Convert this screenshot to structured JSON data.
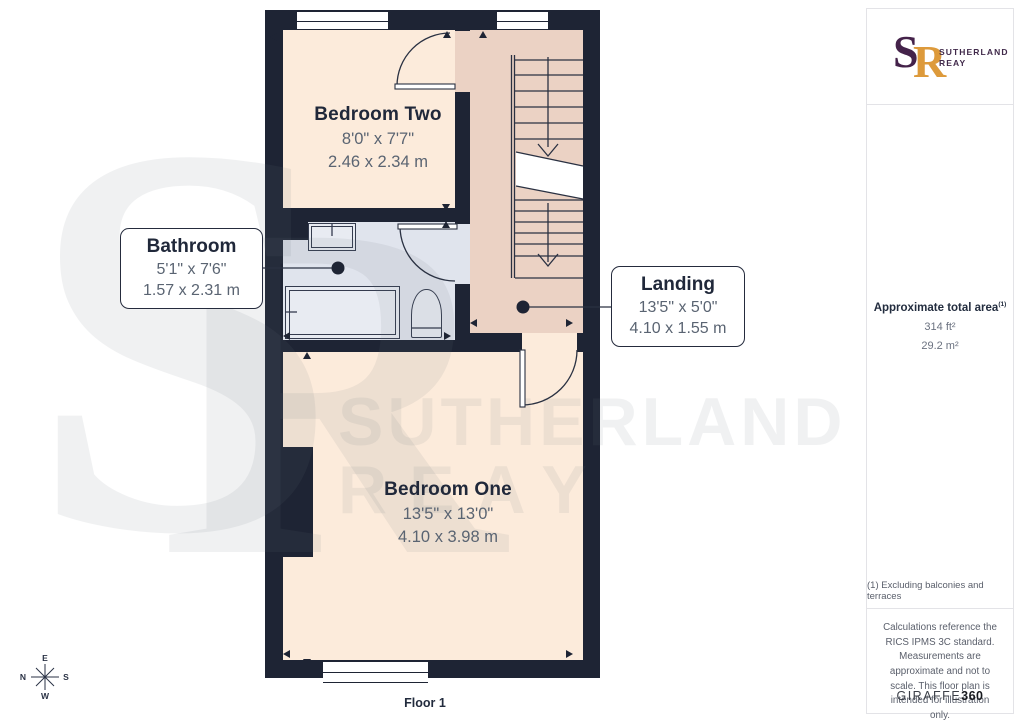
{
  "floor_label": "Floor 1",
  "compass": {
    "top": "E",
    "left": "N",
    "right": "S",
    "bottom": "W"
  },
  "watermark": {
    "monogram_s": "S",
    "monogram_r": "R",
    "line1": "SUTHERLAND",
    "line2": "REAY"
  },
  "rooms": [
    {
      "id": "bedroom-two",
      "name": "Bedroom Two",
      "imperial": "8'0\" x 7'7\"",
      "metric": "2.46 x 2.34 m"
    },
    {
      "id": "bathroom",
      "name": "Bathroom",
      "imperial": "5'1\" x 7'6\"",
      "metric": "1.57 x 2.31 m"
    },
    {
      "id": "landing",
      "name": "Landing",
      "imperial": "13'5\" x 5'0\"",
      "metric": "4.10 x 1.55 m"
    },
    {
      "id": "bedroom-one",
      "name": "Bedroom One",
      "imperial": "13'5\" x 13'0\"",
      "metric": "4.10 x 3.98 m"
    }
  ],
  "sidebar": {
    "logo": {
      "monogram_s": "S",
      "monogram_r": "R",
      "name_line1": "SUTHERLAND",
      "name_line2": "REAY"
    },
    "area": {
      "title": "Approximate total area",
      "sup": "(1)",
      "imperial": "314 ft²",
      "metric": "29.2 m²"
    },
    "note": "(1) Excluding balconies and terraces",
    "disclaimer": "Calculations reference the RICS IPMS 3C standard. Measurements are approximate and not to scale. This floor plan is intended for illustration only.",
    "brand": {
      "name": "GIRAFFE",
      "suffix": "360"
    }
  },
  "colors": {
    "wall": "#1E2434",
    "bedroom_floor": "#FCEBDB",
    "landing_floor": "#EBD2C4",
    "bathroom_floor": "#E0E4ED",
    "logo_purple": "#44224A",
    "logo_orange": "#DD9A3B"
  }
}
